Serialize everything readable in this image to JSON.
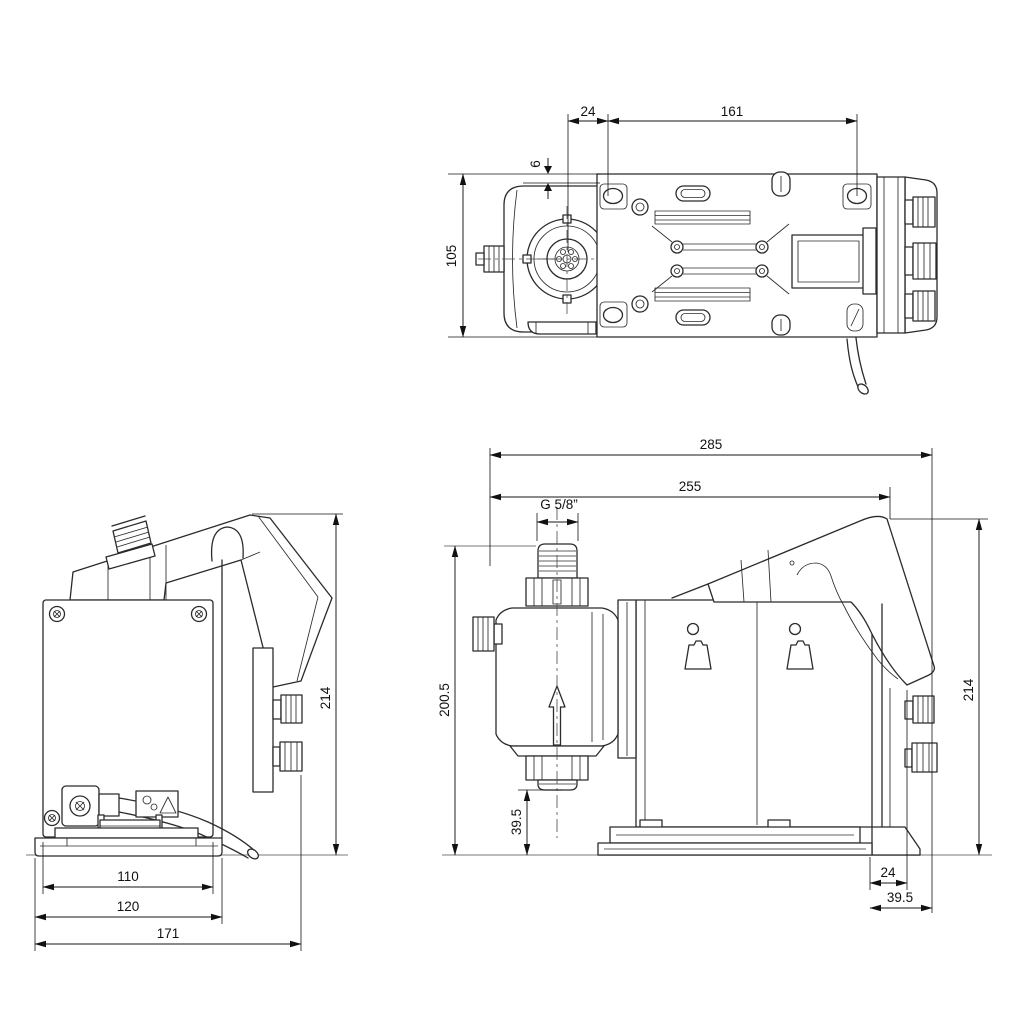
{
  "document": {
    "kind": "technical dimensional drawing - dosing pump, three orthographic views",
    "units": "mm",
    "background_color": "#ffffff",
    "line_color": "#2b2b2b",
    "dimension_color": "#111111",
    "ground_line_color": "#b3b3b3"
  },
  "top_view": {
    "dim_shaft_offset": "24",
    "dim_hole_spacing": "161",
    "dim_edge_offset": "6",
    "dim_width": "105"
  },
  "back_view": {
    "dim_plate_width": "110",
    "dim_base_width": "120",
    "dim_depth": "171",
    "dim_height": "214"
  },
  "side_view": {
    "dim_total_length": "285",
    "dim_length": "255",
    "thread_label": "G 5/8”",
    "dim_height_to_inlet": "200.5",
    "dim_inlet_clearance": "39.5",
    "dim_height": "214",
    "dim_rear_offset": "24",
    "dim_rear_overhang": "39.5"
  }
}
